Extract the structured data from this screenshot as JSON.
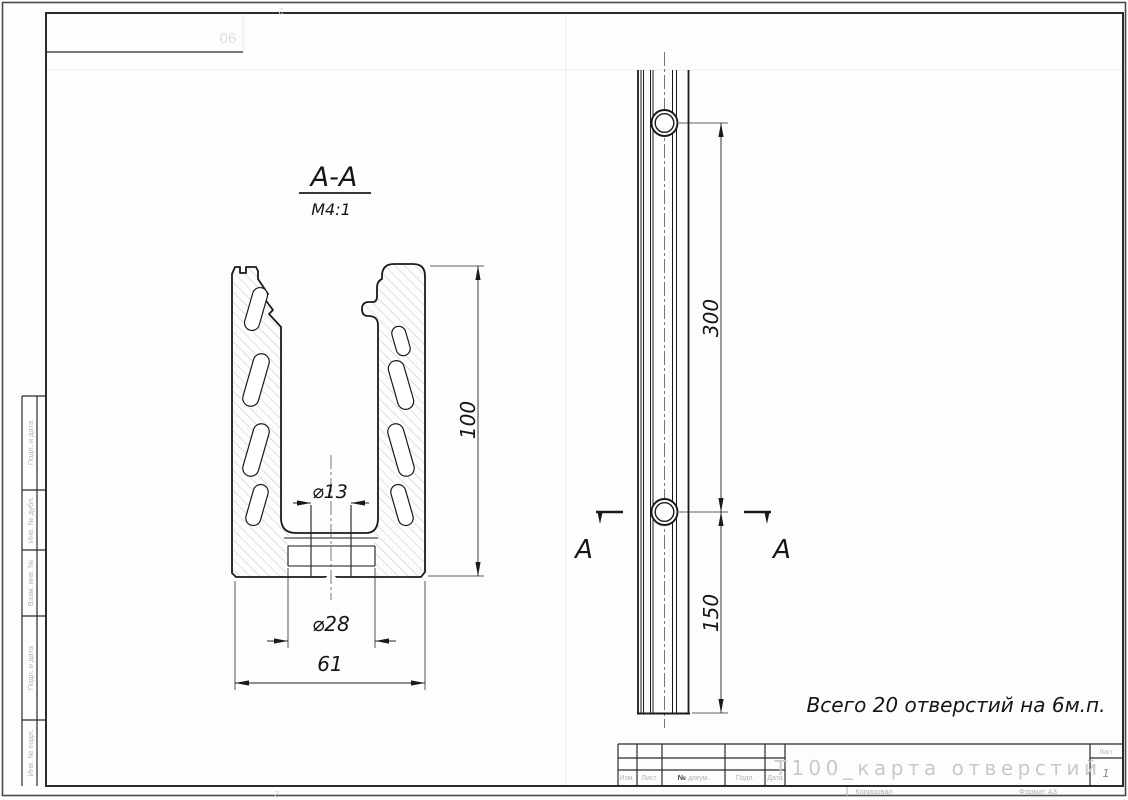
{
  "drawing": {
    "section_label": "А-А",
    "section_scale": "М4:1",
    "note": "Всего 20 отверстий на 6м.п.",
    "cut_letter_left": "А",
    "cut_letter_right": "А"
  },
  "dimensions": {
    "profile_height": "100",
    "hole_diameter": "⌀13",
    "boss_diameter": "⌀28",
    "profile_width": "61",
    "hole_spacing": "300",
    "end_offset": "150"
  },
  "title_block": {
    "doc_title": "Т100_карта отверстий",
    "sheet_label": "Лист",
    "sheet_number": "1",
    "col_izm": "Изм.",
    "col_list": "Лист",
    "col_num_sign": "№",
    "col_dokum": "докум.",
    "col_podp": "Подп.",
    "col_data": "Дата",
    "kopiroval": "Копировал",
    "format": "Формат А3"
  },
  "side_stamps": [
    "Подп. и дата",
    "Инв. № дубл.",
    "Взам. инв. №",
    "Подп. и дата",
    "Инв. № подл."
  ],
  "corner_stamp": {
    "bleed_text": "90",
    "bleed_page_top": "2",
    "bleed_page_bottom": "2"
  },
  "colors": {
    "line": "#1a1a1a",
    "stamp_gray": "#b3b3b3",
    "title_gray": "#c9c9c9",
    "hatch": "#c3c6ca"
  }
}
